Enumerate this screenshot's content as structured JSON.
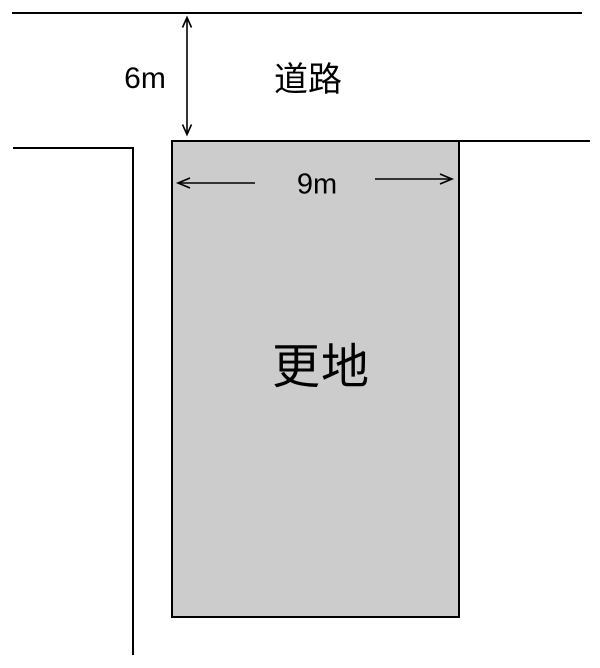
{
  "colors": {
    "background": "#ffffff",
    "line": "#000000",
    "plot_fill": "#cccccc"
  },
  "road": {
    "name_label": "道路",
    "width_label": "6m"
  },
  "plot": {
    "name_label": "更地",
    "frontage_label": "9m"
  }
}
